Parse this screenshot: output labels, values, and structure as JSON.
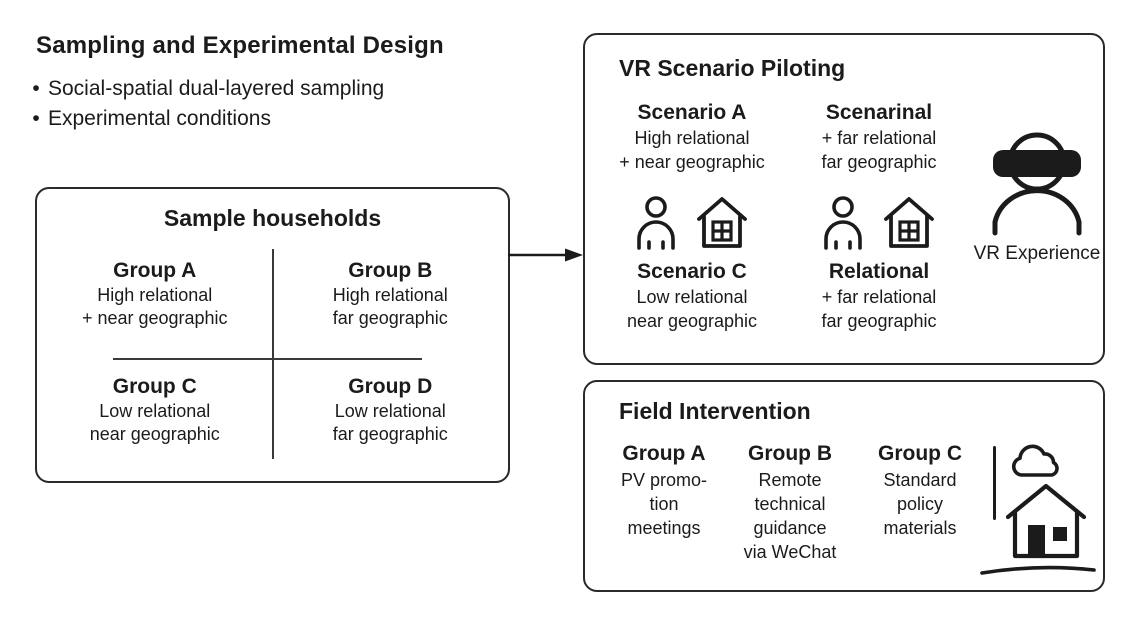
{
  "page": {
    "title": "Sampling and Experimental Design",
    "bullet_marker": "•",
    "bullets": [
      "Social-spatial dual-layered sampling",
      "Experimental conditions"
    ]
  },
  "sample_box": {
    "title": "Sample households",
    "groups": [
      {
        "name": "Group A",
        "lines": [
          "High relational",
          "+ near geographic"
        ]
      },
      {
        "name": "Group B",
        "lines": [
          "High relational",
          "far geographic"
        ]
      },
      {
        "name": "Group C",
        "lines": [
          "Low relational",
          "near geographic"
        ]
      },
      {
        "name": "Group D",
        "lines": [
          "Low relational",
          "far geographic"
        ]
      }
    ]
  },
  "vr_box": {
    "title": "VR Scenario Piloting",
    "scenarios": [
      {
        "name": "Scenario A",
        "lines": [
          "High relational",
          "+ near geographic"
        ]
      },
      {
        "name": "Scenarinal",
        "lines": [
          "+ far relational",
          "far geographic"
        ]
      },
      {
        "name": "Scenario C",
        "lines": [
          "Low relational",
          "near geographic"
        ]
      },
      {
        "name": "Relational",
        "lines": [
          "+ far relational",
          "far geographic"
        ]
      }
    ],
    "vr_label": "VR Experience"
  },
  "field_box": {
    "title": "Field Intervention",
    "groups": [
      {
        "name": "Group A",
        "lines": [
          "PV promo-",
          "tion",
          "meetings"
        ]
      },
      {
        "name": "Group B",
        "lines": [
          "Remote",
          "technical",
          "guidance",
          "via WeChat"
        ]
      },
      {
        "name": "Group C",
        "lines": [
          "Standard",
          "policy",
          "materials"
        ]
      }
    ]
  },
  "colors": {
    "ink": "#1b1b1b",
    "border": "#2a2a2a",
    "background": "#ffffff"
  }
}
